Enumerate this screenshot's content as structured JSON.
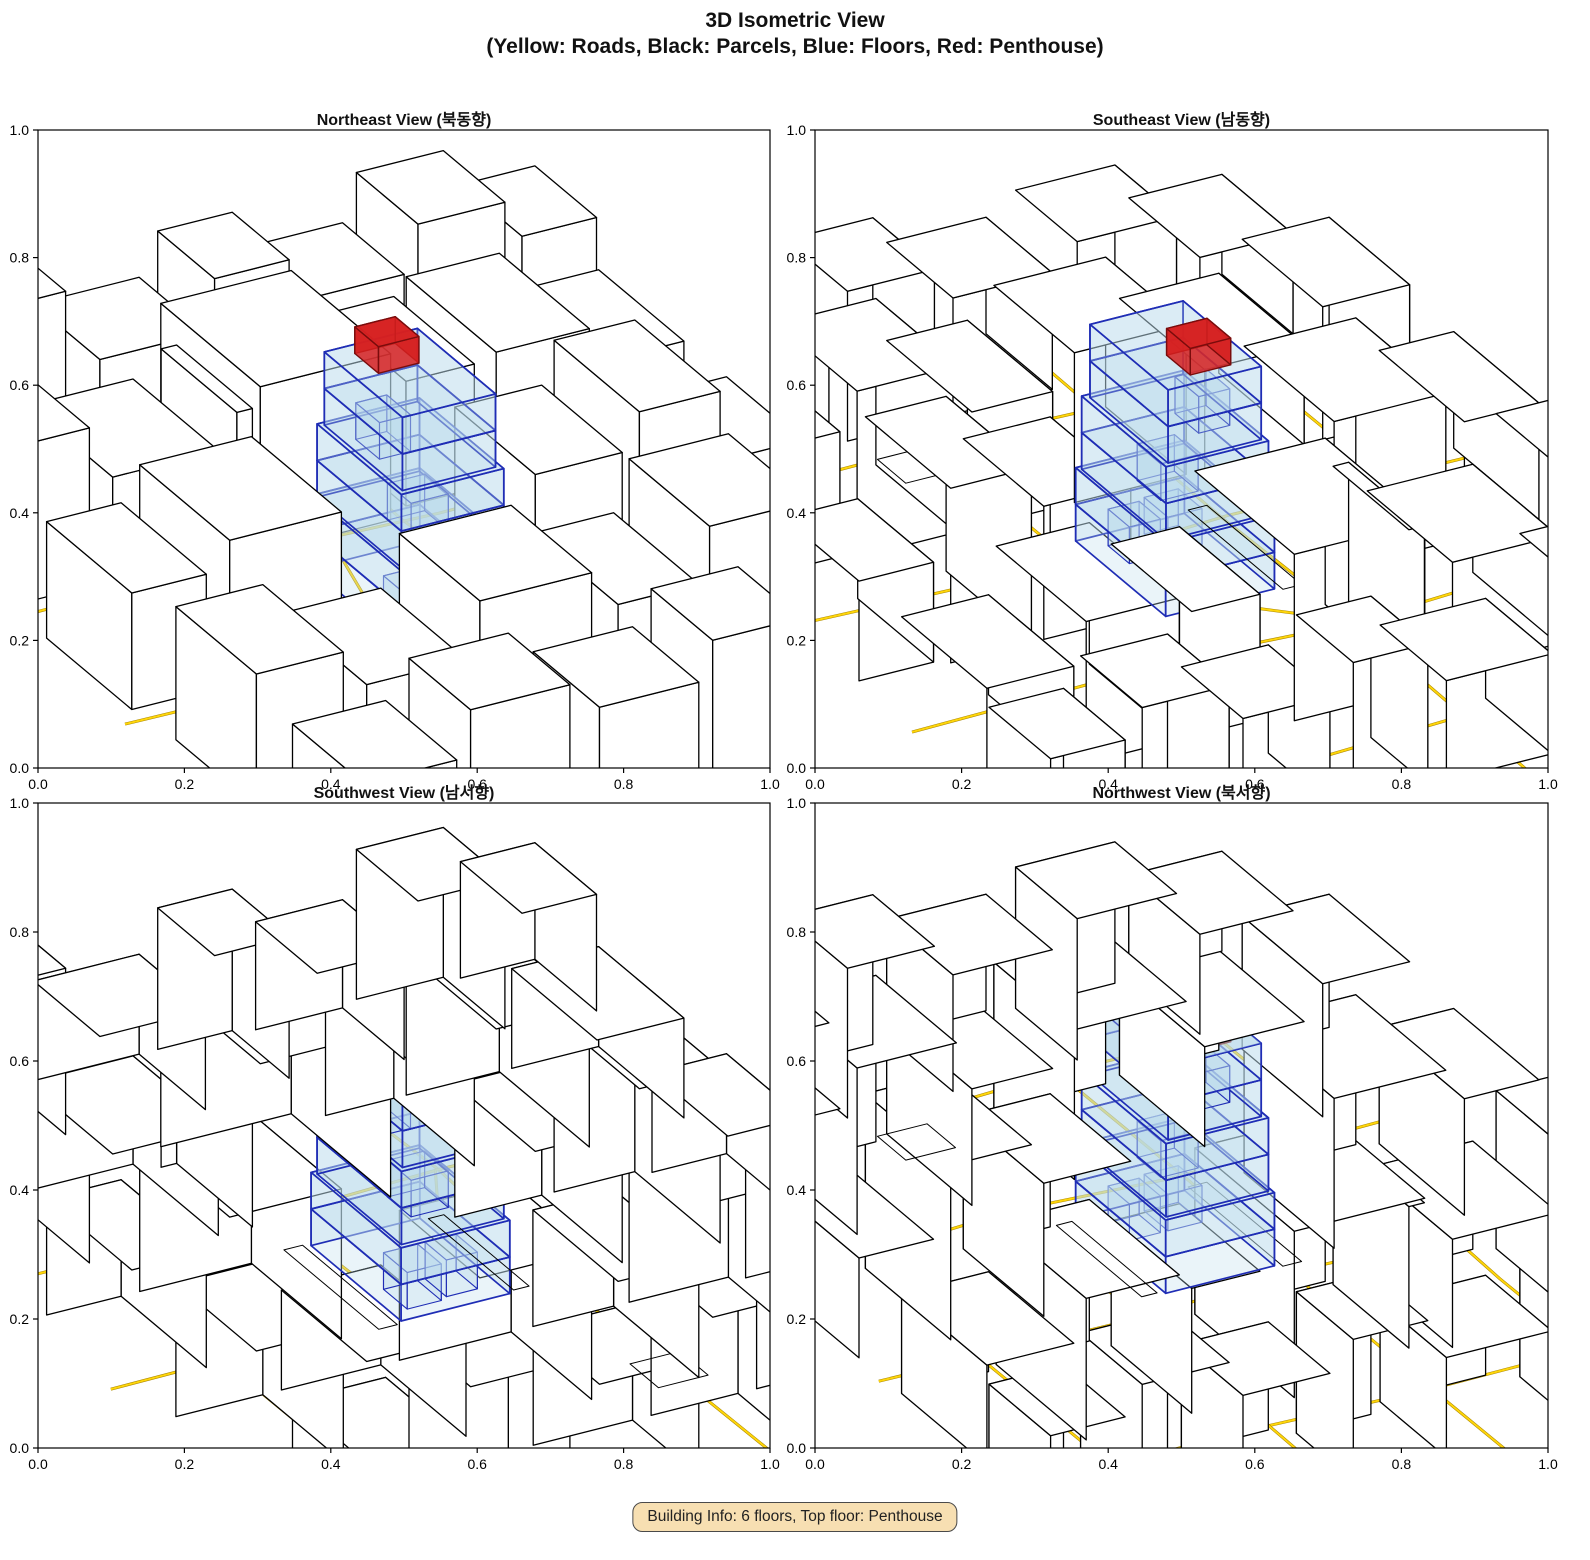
{
  "figure": {
    "suptitle_line1": "3D Isometric View",
    "suptitle_line2": "(Yellow: Roads, Black: Parcels, Blue: Floors, Red: Penthouse)",
    "footer_badge": "Building Info: 6 floors, Top floor: Penthouse"
  },
  "chart_data": {
    "type": "3d-isometric-city",
    "views": [
      {
        "title": "Northeast View (북동향)",
        "rotation_deg": 0
      },
      {
        "title": "Southeast View (남동향)",
        "rotation_deg": 90
      },
      {
        "title": "Southwest View (남서향)",
        "rotation_deg": 180
      },
      {
        "title": "Northwest View (북서향)",
        "rotation_deg": 270
      }
    ],
    "axis": {
      "xlim": [
        0.0,
        1.0
      ],
      "ylim": [
        0.0,
        1.0
      ],
      "xtick_labels": [
        "0.0",
        "0.2",
        "0.4",
        "0.6",
        "0.8",
        "1.0"
      ],
      "ytick_labels": [
        "0.0",
        "0.2",
        "0.4",
        "0.6",
        "0.8",
        "1.0"
      ]
    },
    "colors": {
      "background": "#ffffff",
      "road_core": "#ffd60a",
      "road_casing": "#a98600",
      "parcel_fill": "#ffffff",
      "parcel_edge": "#000000",
      "floors_fill": "#b9d9ec",
      "floors_edge": "#1f2db5",
      "penthouse_fill": "#d62020",
      "penthouse_edge": "#7a0c0c",
      "badge_bg": "#f7dfb2",
      "badge_border": "#4a4a4a",
      "axis_color": "#000000"
    },
    "building": {
      "floors_count": 6,
      "top_floor": "Penthouse",
      "floor_height": 0.022,
      "floors": [
        {
          "x": 0.4,
          "y": 0.375,
          "w": 0.175,
          "d": 0.19
        },
        {
          "x": 0.4,
          "y": 0.375,
          "w": 0.175,
          "d": 0.19
        },
        {
          "x": 0.405,
          "y": 0.381,
          "w": 0.165,
          "d": 0.178
        },
        {
          "x": 0.405,
          "y": 0.381,
          "w": 0.165,
          "d": 0.178
        },
        {
          "x": 0.412,
          "y": 0.388,
          "w": 0.15,
          "d": 0.165
        },
        {
          "x": 0.412,
          "y": 0.388,
          "w": 0.15,
          "d": 0.165
        }
      ],
      "inner_units": [
        {
          "floor": 0,
          "x": 0.425,
          "y": 0.395,
          "w": 0.055,
          "d": 0.05
        },
        {
          "floor": 0,
          "x": 0.492,
          "y": 0.4,
          "w": 0.05,
          "d": 0.045
        },
        {
          "floor": 2,
          "x": 0.458,
          "y": 0.43,
          "w": 0.06,
          "d": 0.05
        },
        {
          "floor": 4,
          "x": 0.43,
          "y": 0.46,
          "w": 0.05,
          "d": 0.05
        }
      ],
      "penthouse": {
        "x": 0.4475,
        "y": 0.485,
        "w": 0.065,
        "d": 0.05,
        "h": 0.016
      }
    },
    "city": {
      "parcels": [
        {
          "x": -0.04,
          "y": 0.88,
          "w": 0.15,
          "d": 0.15,
          "h": 0.075
        },
        {
          "x": 0.13,
          "y": 0.9,
          "w": 0.13,
          "d": 0.12,
          "h": 0.1
        },
        {
          "x": 0.3,
          "y": 0.88,
          "w": 0.17,
          "d": 0.14,
          "h": 0.06
        },
        {
          "x": 0.5,
          "y": 0.9,
          "w": 0.12,
          "d": 0.12,
          "h": 0.085
        },
        {
          "x": 0.65,
          "y": 0.88,
          "w": 0.14,
          "d": 0.13,
          "h": 0.065
        },
        {
          "x": 0.82,
          "y": 0.89,
          "w": 0.14,
          "d": 0.13,
          "h": 0.09
        },
        {
          "x": 0.98,
          "y": 0.88,
          "w": 0.12,
          "d": 0.13,
          "h": 0.07
        },
        {
          "x": -0.03,
          "y": 0.64,
          "w": 0.13,
          "d": 0.19,
          "h": 0.095
        },
        {
          "x": 0.13,
          "y": 0.63,
          "w": 0.17,
          "d": 0.18,
          "h": 0.065
        },
        {
          "x": 0.33,
          "y": 0.63,
          "w": 0.025,
          "d": 0.16,
          "h": 0.085
        },
        {
          "x": 0.36,
          "y": 0.62,
          "w": 0.21,
          "d": 0.21,
          "h": 0.1
        },
        {
          "x": 0.61,
          "y": 0.64,
          "w": 0.11,
          "d": 0.17,
          "h": 0.075
        },
        {
          "x": 0.74,
          "y": 0.62,
          "w": 0.15,
          "d": 0.19,
          "h": 0.085
        },
        {
          "x": 0.91,
          "y": 0.63,
          "w": 0.14,
          "d": 0.18,
          "h": 0.06
        },
        {
          "x": -0.03,
          "y": 0.38,
          "w": 0.12,
          "d": 0.18,
          "h": 0.07
        },
        {
          "x": 0.12,
          "y": 0.37,
          "w": 0.18,
          "d": 0.19,
          "h": 0.09
        },
        {
          "x": 0.62,
          "y": 0.38,
          "w": 0.14,
          "d": 0.17,
          "h": 0.08
        },
        {
          "x": 0.78,
          "y": 0.37,
          "w": 0.13,
          "d": 0.18,
          "h": 0.105
        },
        {
          "x": 0.93,
          "y": 0.38,
          "w": 0.12,
          "d": 0.16,
          "h": 0.06
        },
        {
          "x": -0.02,
          "y": 0.13,
          "w": 0.14,
          "d": 0.17,
          "h": 0.08
        },
        {
          "x": 0.15,
          "y": 0.12,
          "w": 0.16,
          "d": 0.18,
          "h": 0.06
        },
        {
          "x": 0.34,
          "y": 0.13,
          "w": 0.18,
          "d": 0.17,
          "h": 0.09
        },
        {
          "x": 0.555,
          "y": 0.12,
          "w": 0.13,
          "d": 0.18,
          "h": 0.07
        },
        {
          "x": 0.71,
          "y": 0.13,
          "w": 0.16,
          "d": 0.17,
          "h": 0.1
        },
        {
          "x": 0.89,
          "y": 0.12,
          "w": 0.14,
          "d": 0.17,
          "h": 0.075
        },
        {
          "x": 0.0,
          "y": -0.07,
          "w": 0.15,
          "d": 0.15,
          "h": 0.06
        },
        {
          "x": 0.18,
          "y": -0.06,
          "w": 0.16,
          "d": 0.13,
          "h": 0.085
        },
        {
          "x": 0.38,
          "y": -0.07,
          "w": 0.16,
          "d": 0.14,
          "h": 0.07
        },
        {
          "x": 0.57,
          "y": -0.06,
          "w": 0.14,
          "d": 0.13,
          "h": 0.09
        },
        {
          "x": 0.74,
          "y": -0.07,
          "w": 0.16,
          "d": 0.14,
          "h": 0.06
        },
        {
          "x": 0.92,
          "y": -0.06,
          "w": 0.13,
          "d": 0.13,
          "h": 0.08
        },
        {
          "x": 0.36,
          "y": 0.37,
          "w": 0.03,
          "d": 0.2,
          "h": 0.0
        },
        {
          "x": 0.585,
          "y": 0.38,
          "w": 0.025,
          "d": 0.18,
          "h": 0.0
        },
        {
          "x": 0.62,
          "y": 0.12,
          "w": 0.08,
          "d": 0.06,
          "h": 0.0
        }
      ],
      "roads": [
        [
          [
            0.095,
            -0.06
          ],
          [
            0.1,
            0.3
          ],
          [
            0.085,
            0.62
          ],
          [
            0.095,
            1.06
          ]
        ],
        [
          [
            0.335,
            -0.06
          ],
          [
            0.34,
            0.18
          ],
          [
            0.33,
            0.35
          ],
          [
            0.345,
            0.6
          ],
          [
            0.335,
            1.06
          ]
        ],
        [
          [
            0.595,
            -0.06
          ],
          [
            0.6,
            0.35
          ],
          [
            0.585,
            0.62
          ],
          [
            0.6,
            1.06
          ]
        ],
        [
          [
            0.875,
            -0.06
          ],
          [
            0.87,
            0.3
          ],
          [
            0.88,
            0.63
          ],
          [
            0.875,
            1.06
          ]
        ],
        [
          [
            -0.06,
            0.105
          ],
          [
            0.3,
            0.11
          ],
          [
            0.62,
            0.1
          ],
          [
            1.06,
            0.105
          ]
        ],
        [
          [
            -0.06,
            0.355
          ],
          [
            0.33,
            0.35
          ],
          [
            0.6,
            0.36
          ],
          [
            1.06,
            0.355
          ]
        ],
        [
          [
            -0.06,
            0.615
          ],
          [
            0.36,
            0.62
          ],
          [
            0.64,
            0.61
          ],
          [
            1.06,
            0.615
          ]
        ],
        [
          [
            -0.06,
            0.865
          ],
          [
            0.4,
            0.87
          ],
          [
            0.7,
            0.86
          ],
          [
            1.06,
            0.865
          ]
        ],
        [
          [
            0.335,
            0.35
          ],
          [
            0.42,
            0.47
          ],
          [
            0.47,
            0.62
          ]
        ]
      ]
    }
  }
}
